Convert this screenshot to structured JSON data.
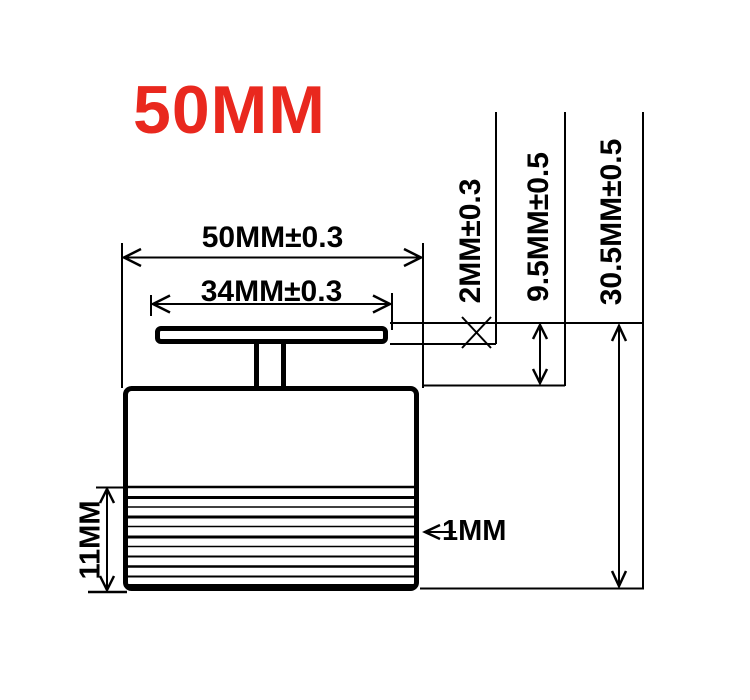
{
  "title": {
    "text": "50MM",
    "color": "#e9281e"
  },
  "diagram": {
    "type": "technical-drawing",
    "subject": "speaker-side-view-with-dimensions",
    "labels": {
      "outer_width": "50MM±0.3",
      "plate_width": "34MM±0.3",
      "plate_thickness": "2MM±0.3",
      "upper_height": "9.5MM±0.5",
      "total_height": "30.5MM±0.5",
      "ribbed_height": "11MM",
      "rib_pitch": "1MM"
    }
  },
  "colors": {
    "line": "#000000",
    "background": "#ffffff",
    "accent": "#e9281e"
  }
}
